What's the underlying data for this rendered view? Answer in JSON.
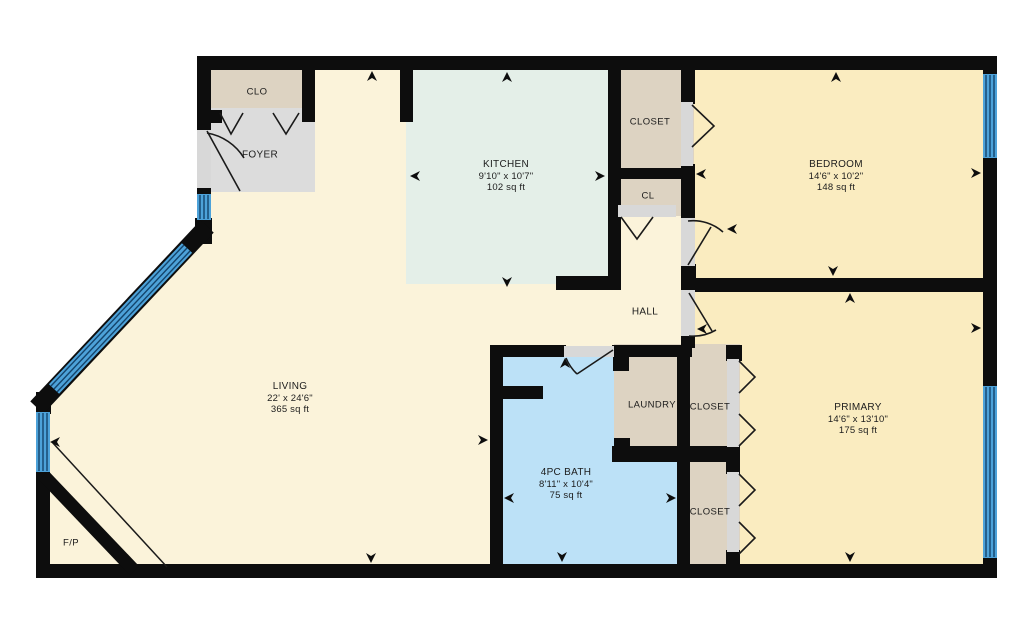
{
  "plan": {
    "rooms": {
      "clo": {
        "name": "CLO"
      },
      "foyer": {
        "name": "FOYER"
      },
      "kitchen": {
        "name": "KITCHEN",
        "dims": "9'10\" x 10'7\"",
        "area": "102 sq ft"
      },
      "closet_bedroom": {
        "name": "CLOSET"
      },
      "cl": {
        "name": "CL"
      },
      "bedroom": {
        "name": "BEDROOM",
        "dims": "14'6\" x 10'2\"",
        "area": "148 sq ft"
      },
      "hall": {
        "name": "HALL"
      },
      "living": {
        "name": "LIVING",
        "dims": "22' x 24'6\"",
        "area": "365 sq ft"
      },
      "laundry": {
        "name": "LAUNDRY"
      },
      "closet_primary_upper": {
        "name": "CLOSET"
      },
      "primary": {
        "name": "PRIMARY",
        "dims": "14'6\" x 13'10\"",
        "area": "175 sq ft"
      },
      "bath": {
        "name": "4PC BATH",
        "dims": "8'11\" x 10'4\"",
        "area": "75 sq ft"
      },
      "closet_primary_lower": {
        "name": "CLOSET"
      },
      "fireplace": {
        "name": "F/P"
      }
    },
    "colors": {
      "wall": "#0d0d0d",
      "door_line": "#1a1a1a",
      "floor_main": "#fbf3da",
      "floor_bedroom": "#faecc0",
      "floor_kitchen": "#e4efe8",
      "floor_bath": "#bce1f7",
      "floor_closet": "#ddd3c2",
      "floor_foyer": "#dcdcdc",
      "door_opening": "#d8d8d8",
      "window_fill": "#4da2d9",
      "window_line": "#14446b",
      "background": "#ffffff"
    }
  }
}
